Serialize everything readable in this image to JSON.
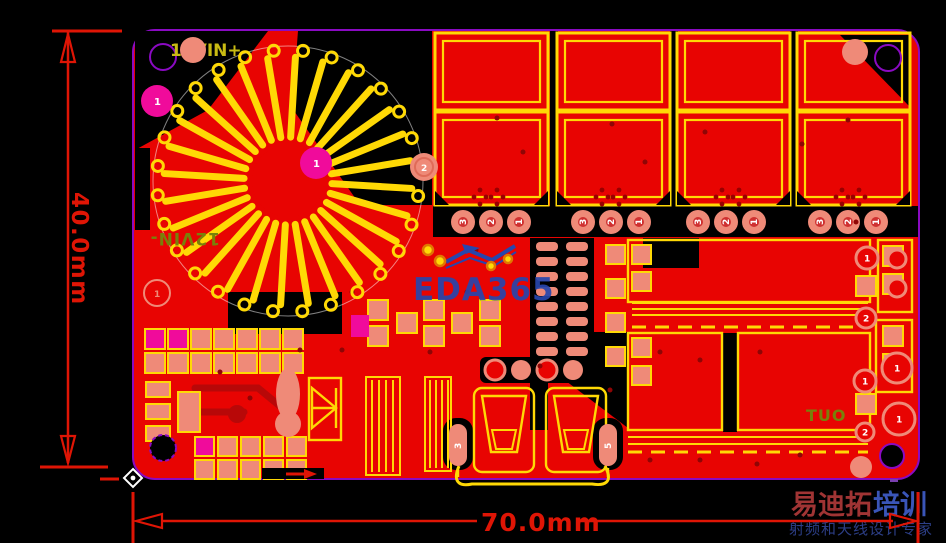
{
  "viewer": {
    "canvas_bg": "#000000"
  },
  "dimensions": {
    "height_label": "40.0mm",
    "width_label": "70.0mm"
  },
  "silkscreen": {
    "input_pos": "12VIN+",
    "input_neg_mirrored": "12VIN-",
    "output_mirrored": "TUO"
  },
  "watermarks": {
    "center": "EDA365",
    "brand_title_a": "易迪拓",
    "brand_title_b": "培训",
    "brand_subtitle": "射频和天线设计专家"
  },
  "pad_labels": {
    "pad1": "1",
    "pad2": "2",
    "pad3": "3",
    "pad5": "5",
    "pin_trio": [
      "3",
      "2",
      "1"
    ]
  },
  "colors": {
    "copper_red": "#e80402",
    "dark_red": "#b80808",
    "via_dark_red": "#8f0505",
    "silk_yellow": "#ffd905",
    "pad_salmon": "#ef8a78",
    "pad_magenta": "#f00b9b",
    "board_outline_purple": "#8a0ac2",
    "dimension_red": "#df1505",
    "watermark_blue": "#2746ad",
    "olive_silk": "#78810a",
    "silk_label_yellow": "#c9bb13",
    "brand_red": "#a03434",
    "brand_blue": "#3a55b8",
    "brand_navy": "#2c3e86"
  }
}
